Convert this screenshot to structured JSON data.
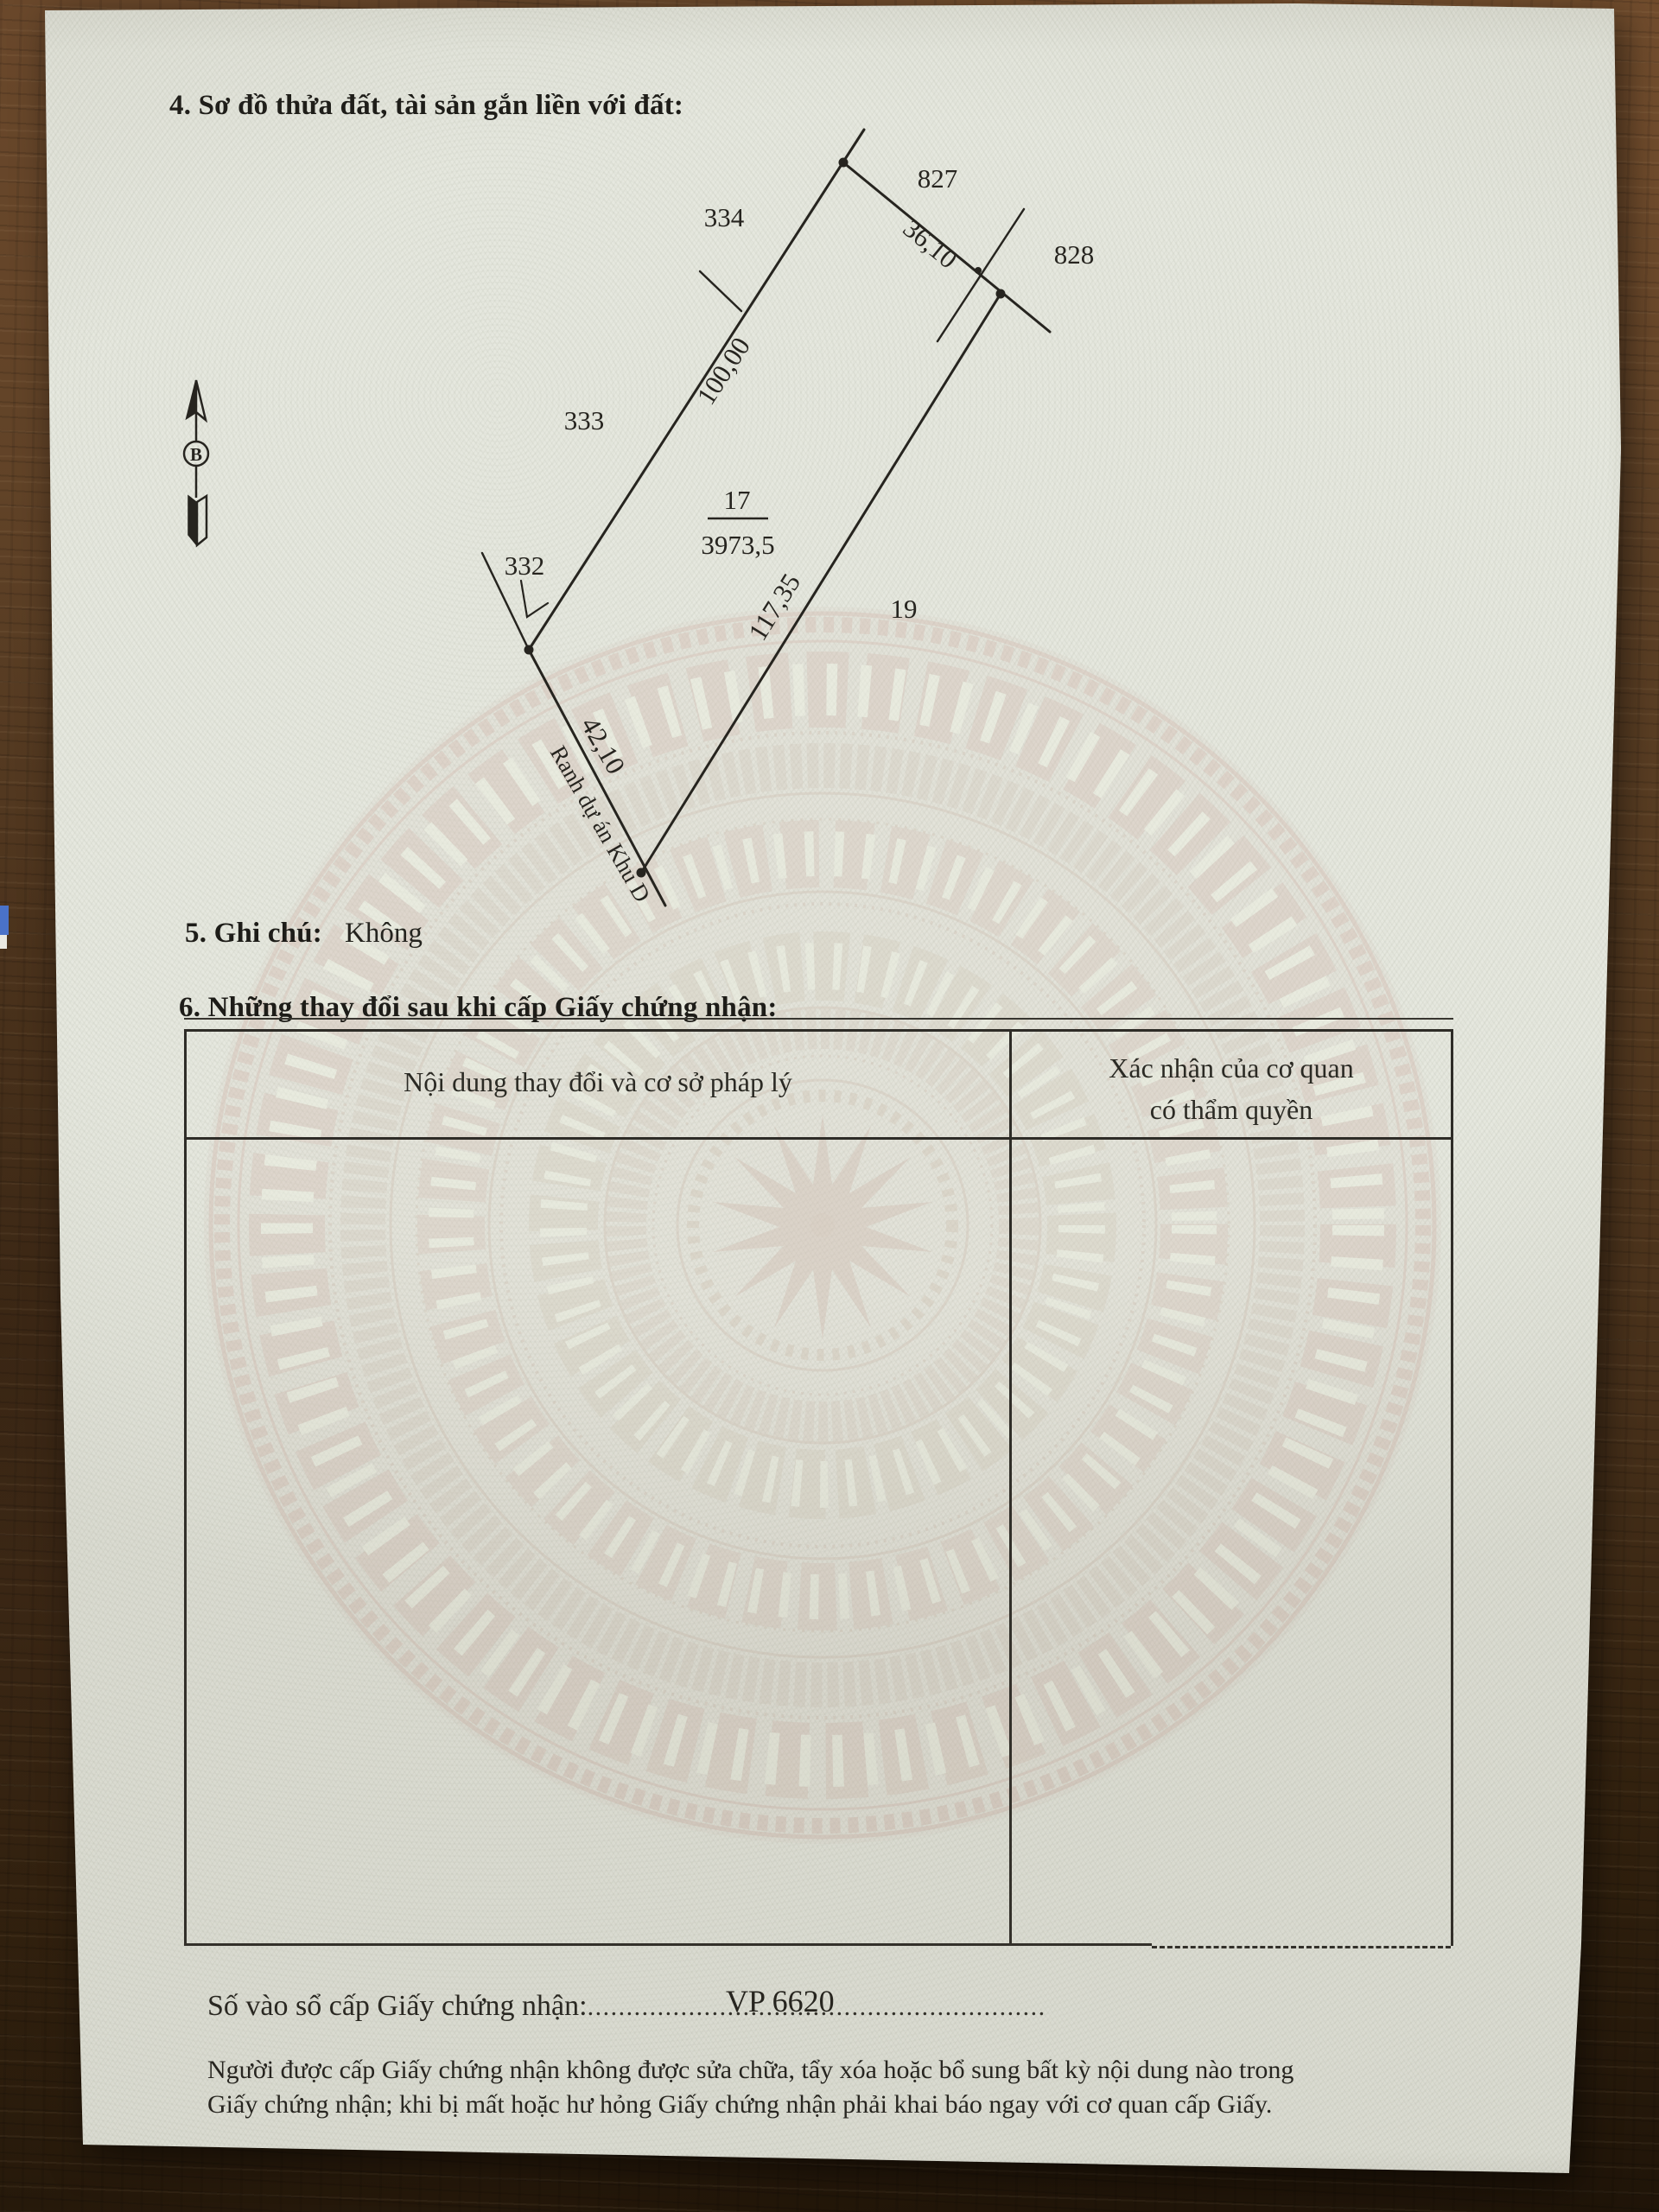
{
  "doc": {
    "section4_title": "4. Sơ đồ thửa đất, tài sản gắn liền với đất:",
    "section5_label": "5. Ghi chú:",
    "section5_value": "Không",
    "section6_title": "6. Những thay đổi sau khi cấp Giấy chứng nhận:",
    "table": {
      "col1_header": "Nội dung thay đổi và cơ sở pháp lý",
      "col2_header_line1": "Xác nhận của cơ quan",
      "col2_header_line2": "có thẩm quyền"
    },
    "serial": {
      "label": "Số vào sổ cấp Giấy chứng nhận:",
      "dots": "...........................................................",
      "value": "VP 6620"
    },
    "footer": {
      "line1": "Người được cấp Giấy chứng nhận không được sửa chữa, tẩy xóa hoặc bổ sung bất kỳ nội dung nào trong",
      "line2": "Giấy chứng nhận; khi bị mất hoặc hư hỏng Giấy chứng nhận phải khai báo ngay với cơ quan cấp Giấy."
    }
  },
  "compass": {
    "label": "B"
  },
  "diagram": {
    "parcel": {
      "number": "17",
      "area": "3973,5"
    },
    "neighbors": {
      "p827": "827",
      "p828": "828",
      "p334": "334",
      "p333": "333",
      "p332": "332",
      "p19": "19"
    },
    "dims": {
      "top": "36,10",
      "left": "100,00",
      "right": "117,35",
      "bottom": "42,10"
    },
    "boundary_label": "Ranh dự án Khu D"
  },
  "colors": {
    "ink": "#26241f",
    "paper": "#e6e8df",
    "wood": "#5e4126",
    "watermark": "#d2bcb2",
    "tab_blue": "#4a72c8"
  }
}
